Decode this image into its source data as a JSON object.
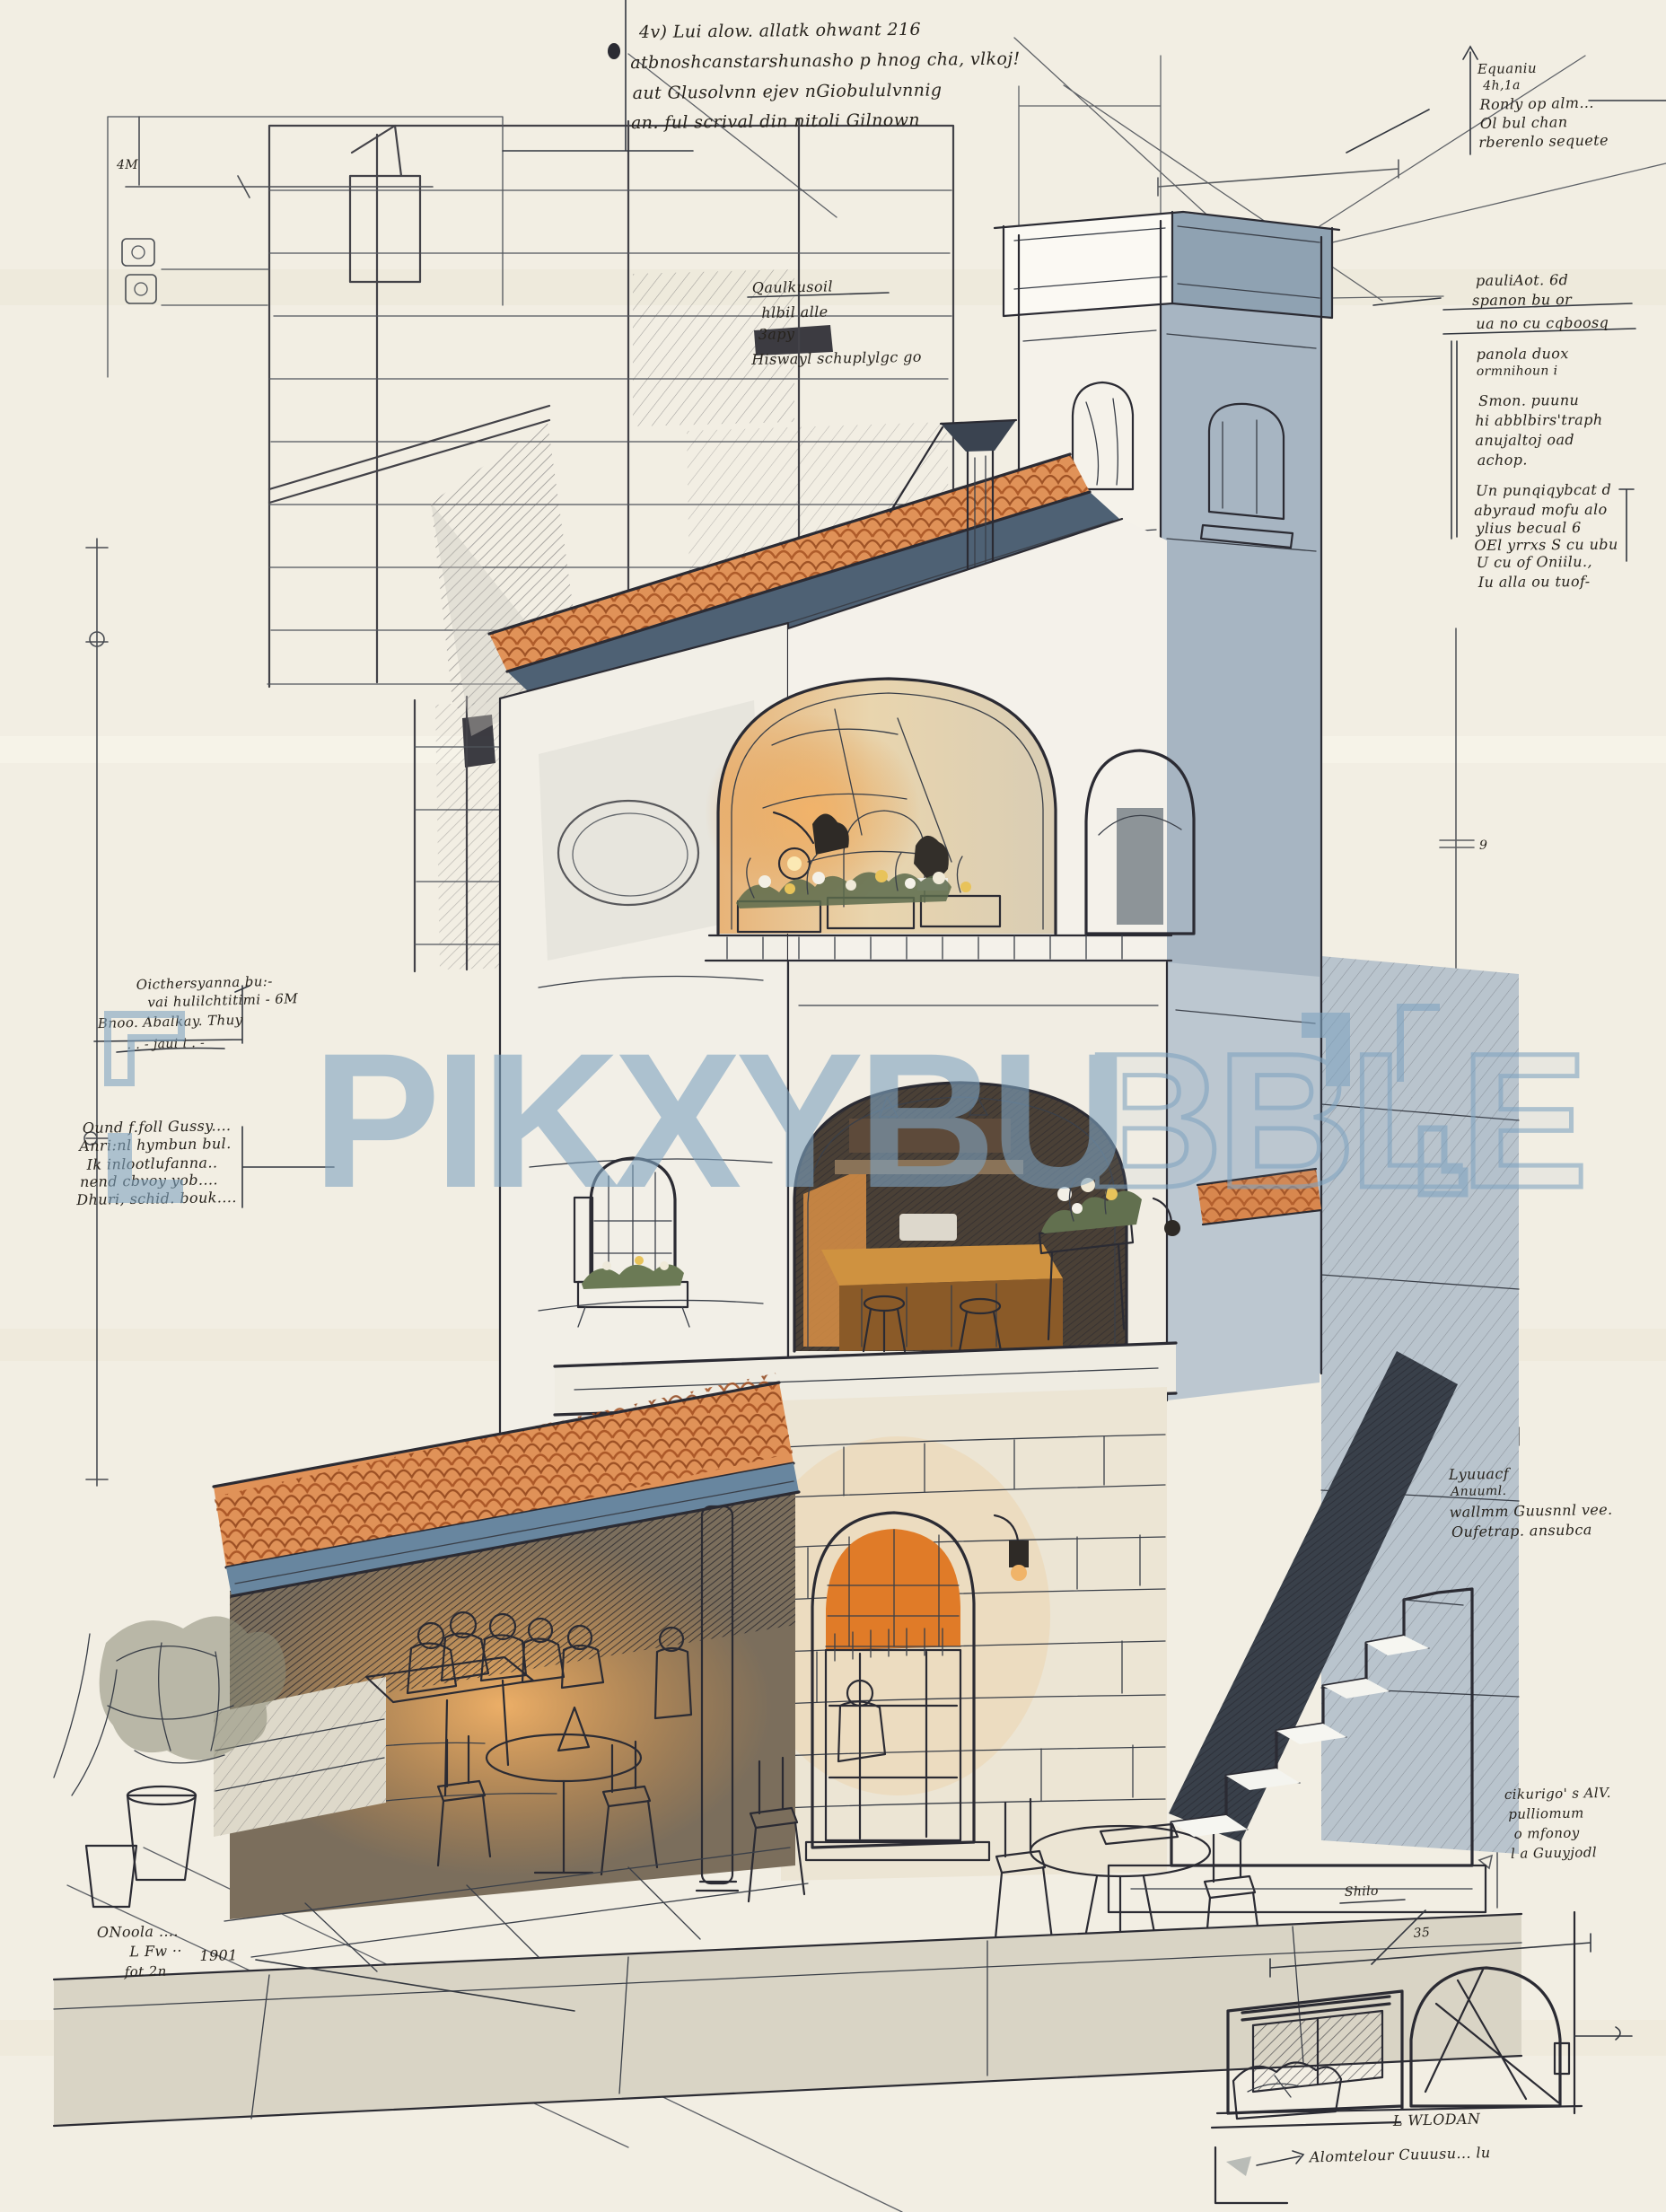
{
  "artwork": {
    "type": "architectural-sketch",
    "subject": "mediterranean cafe building with tower, tiled awning and outdoor seating"
  },
  "watermark": {
    "text_solid": "PIKXYBU",
    "text_outline": "BBLE",
    "color": "#7fa3c0"
  },
  "annotations": {
    "top_note": {
      "lines": [
        "4v) Lui alow. allatk ohwant   216",
        "atbnoshcanstarshunasho p hnog cha, vlkoj!",
        "aut Glusolvnn ejev nGiobululvnnig",
        "an. ful scrival din nitoli Gilnown"
      ]
    },
    "plan_note": {
      "lines": [
        "Qaulkusoil",
        "hlbil alle",
        "3apy",
        "Hiswayl schuplylgc go"
      ]
    },
    "right_top": {
      "lines": [
        "Equaniu",
        "4h,1a",
        "Ronly op alm...",
        "Ol bul chan",
        "rberenlo sequete"
      ]
    },
    "right_mid": {
      "lines": [
        "pauliAot.   6d",
        "spanon bu or",
        "ua no cu cqboosq",
        "panola duox",
        "ormnihoun i",
        "Smon. puunu",
        "hi abblbirs'traph",
        "anujaltoj oad",
        "achop.",
        "Un punqiqybcat d",
        "abyraud mofu alo",
        "ylius becual 6",
        "OEl yrrxs S cu ubu",
        "U cu of Oniilu.,",
        "Iu alla ou tuof-"
      ]
    },
    "left_block_a": {
      "lines": [
        "Oicthersyanna bu:-",
        "vai hulilchtitimi - 6M",
        "Bnoo. Abalkay. Thuy",
        ".   .   -   jaui i   .   -"
      ]
    },
    "left_block_b": {
      "lines": [
        "Ound f.foll Gussy....",
        "Anri:nl hymbun bul.",
        "Ik inlootlufanna..",
        "nend cbvoy yob....",
        "Dhuri, schid. bouk...."
      ]
    },
    "stairs_note": {
      "lines": [
        "Lyuuacf",
        "Anuuml.",
        "wallmm Guusnnl vee.",
        "Oufetrap. ansubca"
      ]
    },
    "right_lower": {
      "lines": [
        "cikurigo' s AlV.",
        "pulliomum",
        "o mfonoy",
        "l a Guuyjodl"
      ]
    },
    "bottom_left": {
      "lines": [
        "ONoola ....",
        "L Fw ··",
        "fot 2n"
      ],
      "year": "1901"
    },
    "detail_caption": {
      "lines": [
        "L WLODAN",
        "Alomtelour Cuuusu... lu"
      ]
    },
    "labels": {
      "shilo": "Shilo",
      "dim_35": "35",
      "dim_4m": "4M",
      "dim_9": "9"
    }
  },
  "palette": {
    "paper": "#f2eee3",
    "ink": "#2b2b33",
    "terracotta": "#e09258",
    "terracotta_dark": "#a34e1f",
    "slate_fascia": "#68869f",
    "tower_shade": "#a7b5c2",
    "warm_glow": "#e8993f",
    "door_wood": "#b5702f",
    "watermark_blue": "#7fa3c0"
  }
}
